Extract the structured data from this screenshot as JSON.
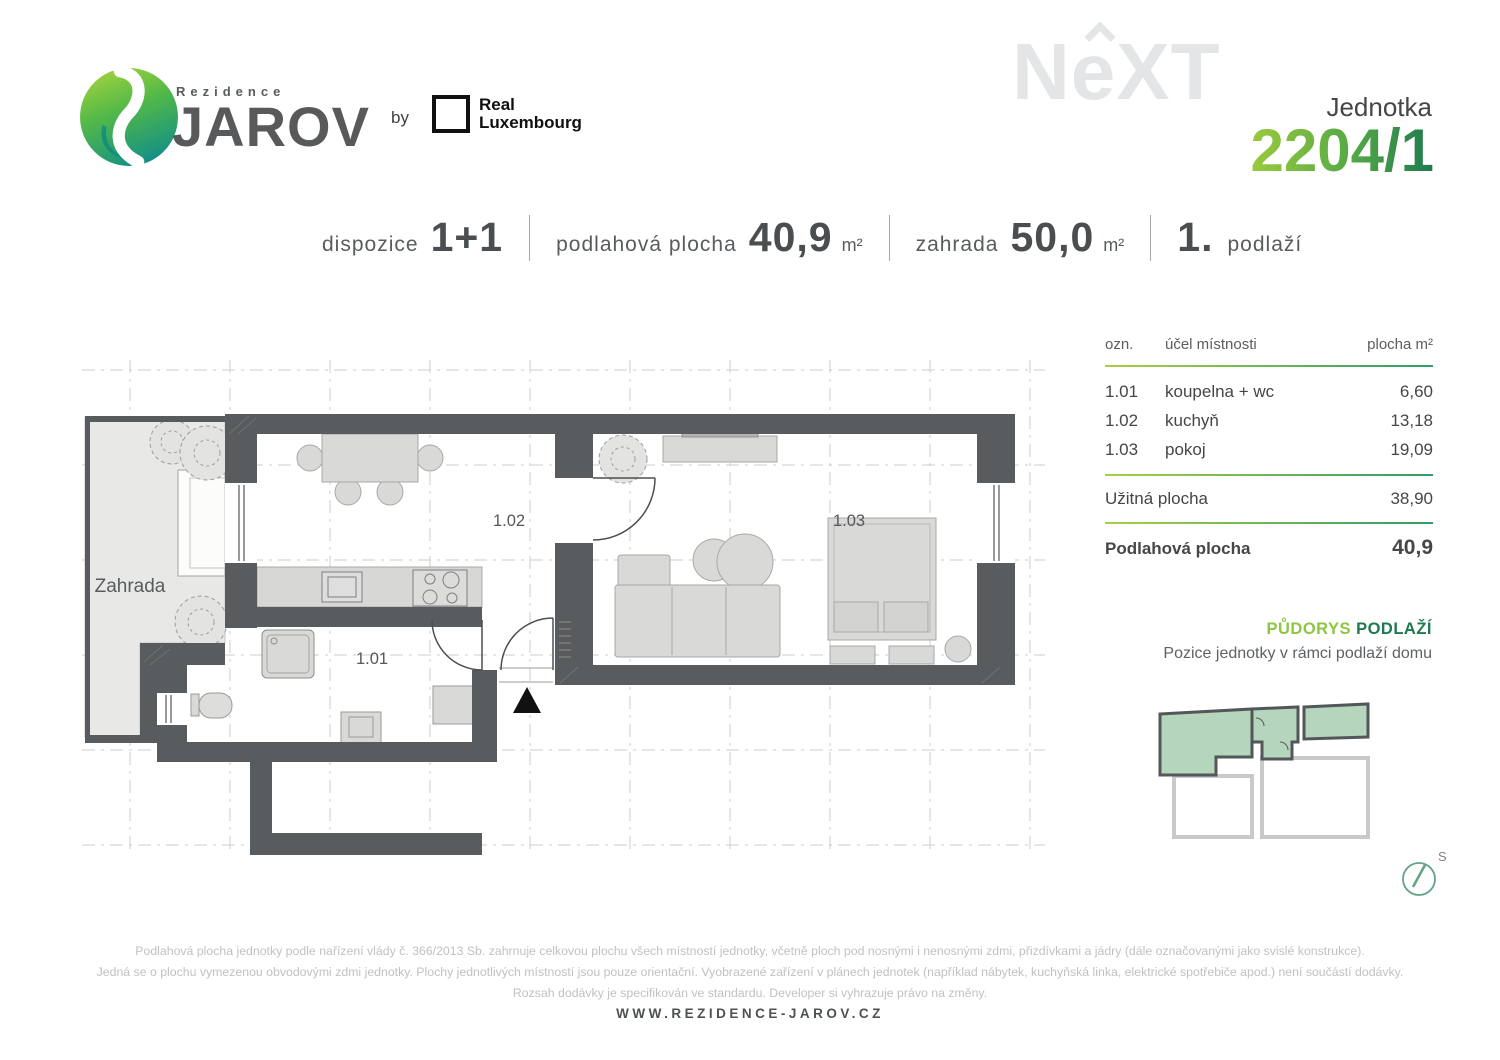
{
  "header": {
    "brand_pretitle": "Rezidence",
    "brand_name": "JAROV",
    "by_label": "by",
    "partner_name_line1": "Real",
    "partner_name_line2": "Luxembourg",
    "watermark": "NeXT",
    "unit_label": "Jednotka",
    "unit_number": "2204/1"
  },
  "specs": {
    "dispozice_label": "dispozice",
    "dispozice_value": "1+1",
    "plocha_label": "podlahová plocha",
    "plocha_value": "40,9",
    "plocha_unit": "m²",
    "zahrada_label": "zahrada",
    "zahrada_value": "50,0",
    "zahrada_unit": "m²",
    "podlazi_value": "1.",
    "podlazi_label": "podlaží"
  },
  "room_table": {
    "col_ozn": "ozn.",
    "col_ucel": "účel místnosti",
    "col_plocha": "plocha m²",
    "rows": [
      {
        "id": "1.01",
        "name": "koupelna + wc",
        "area": "6,60"
      },
      {
        "id": "1.02",
        "name": "kuchyň",
        "area": "13,18"
      },
      {
        "id": "1.03",
        "name": "pokoj",
        "area": "19,09"
      }
    ],
    "subtotal_label": "Užitná plocha",
    "subtotal_value": "38,90",
    "total_label": "Podlahová plocha",
    "total_value": "40,9"
  },
  "floorplan": {
    "garden_label": "Zahrada",
    "room_101": "1.01",
    "room_102": "1.02",
    "room_103": "1.03"
  },
  "minimap": {
    "title_word1": "PŮDORYS",
    "title_word2": "PODLAŽÍ",
    "subtitle": "Pozice jednotky v rámci podlaží domu",
    "compass_label": "S"
  },
  "colors": {
    "wall": "#595c5e",
    "accent_light_green": "#9bca3d",
    "accent_dark_green": "#1e7a4e",
    "minimap_unit_fill": "#b5d5bd"
  },
  "footer": {
    "line1": "Podlahová plocha jednotky podle nařízení vlády č. 366/2013 Sb. zahrnuje celkovou plochu všech místností jednotky, včetně ploch pod nosnými i nenosnými zdmi, přizdívkami a jádry (dále označovanými jako svislé konstrukce).",
    "line2": "Jedná se o plochu vymezenou obvodovými zdmi jednotky. Plochy jednotlivých místností jsou pouze orientační. Vyobrazené zařízení v plánech jednotek (například nábytek, kuchyňská linka, elektrické spotřebiče apod.) není součástí dodávky.",
    "line3": "Rozsah dodávky je specifikován ve standardu. Developer si vyhrazuje právo na změny.",
    "website": "WWW.REZIDENCE-JAROV.CZ"
  }
}
